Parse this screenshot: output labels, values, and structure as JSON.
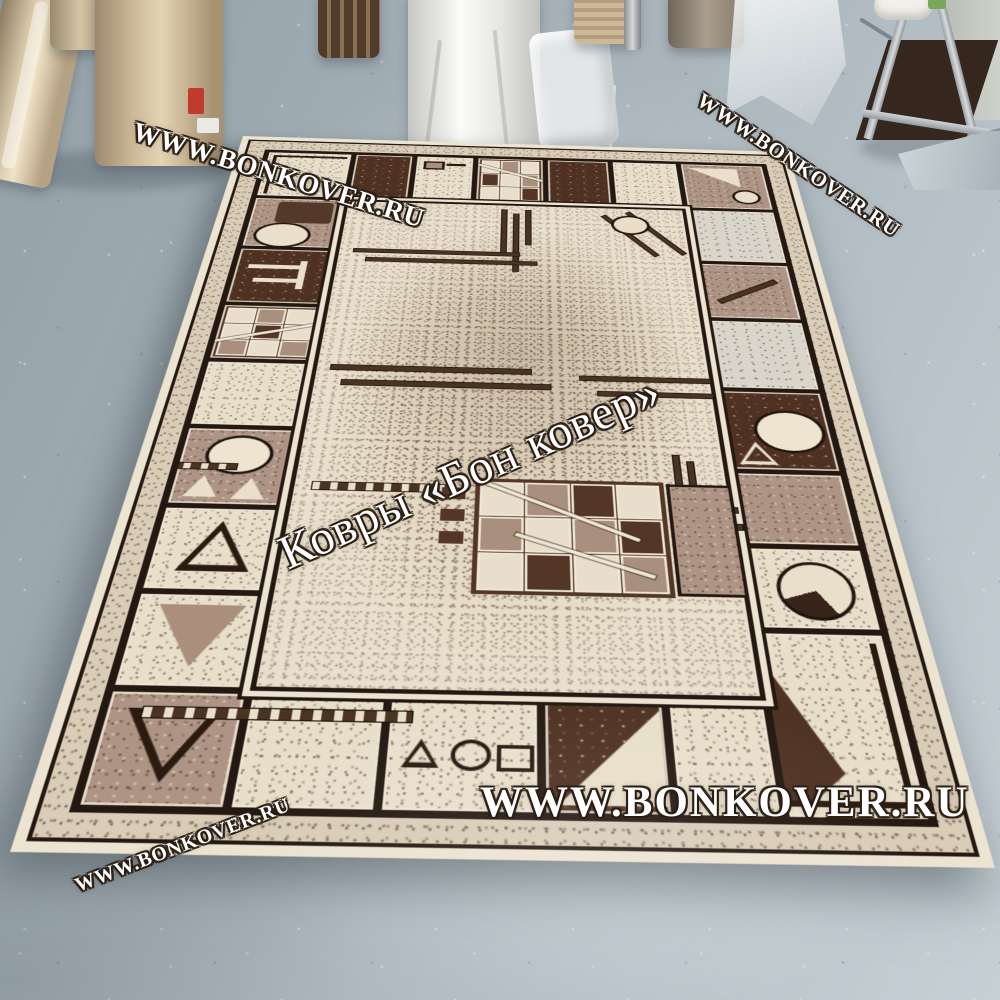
{
  "watermarks": {
    "instances": [
      {
        "id": "top-left",
        "text": "WWW.BONKOVER.RU"
      },
      {
        "id": "top-right",
        "text": "WWW.BONKOVER.RU"
      },
      {
        "id": "center-brand",
        "text": "Ковры «Бон ковер»"
      },
      {
        "id": "bottom-center",
        "text": "WWW.BONKOVER.RU"
      },
      {
        "id": "bottom-left",
        "text": "WWW.BONKOVER.RU"
      }
    ]
  },
  "colors": {
    "floor": "#a6b1b8",
    "rug_fringe": "#ece3d1",
    "rug_cream": "#e8dfcb",
    "rug_taupe": "#ad9484",
    "rug_dark_brown": "#4e3121",
    "rug_outline_black": "#241812",
    "watermark_fill": "#ffffff",
    "wall": "#c6cbc3",
    "roll_label_red": "#c03b2e"
  },
  "rug_corners_px": {
    "top_left": [
      243,
      136
    ],
    "top_right": [
      788,
      152
    ],
    "bottom_right": [
      995,
      868
    ],
    "bottom_left": [
      10,
      852
    ]
  }
}
